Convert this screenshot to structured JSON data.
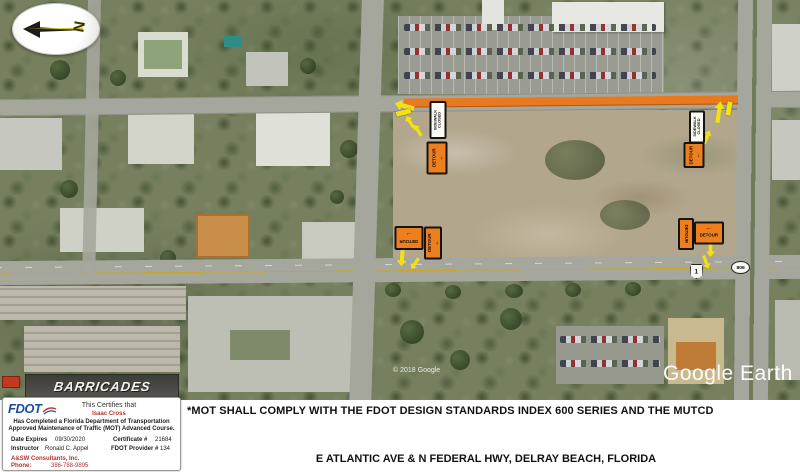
{
  "map": {
    "watermark": "Google Earth",
    "copyright": "© 2018 Google",
    "barricades_sign": "BARRICADES",
    "compass": {
      "letter": "N"
    },
    "shields": {
      "us1": "1",
      "sr806": "806"
    },
    "signs": {
      "sidewalk_closed": "SIDEWALK CLOSED",
      "detour": "DETOUR"
    }
  },
  "icons": {
    "arrow_left": "←",
    "arrow_right": "→"
  },
  "colors": {
    "work_zone_orange": "#E8791E",
    "sign_orange": "#EE7F1E",
    "marker_yellow": "#F2E20F"
  },
  "certification": {
    "logo_text": "FDOT",
    "certifies_label": "This Certifies that",
    "name": "Isaac Cross",
    "completion_line1": "Has Completed a Florida Department of Transportation",
    "completion_line2": "Approved Maintenance of Traffic (MOT) Advanced Course.",
    "date_expires_label": "Date Expires",
    "date_expires_value": "09/30/2020",
    "certificate_label": "Certificate #",
    "certificate_value": "21684",
    "instructor_label": "Instructor",
    "instructor_value": "Ronald C. Appel",
    "provider_label": "FDOT Provider #",
    "provider_value": "134",
    "company": "A&SW Consultants, Inc.",
    "phone_label": "Phone:",
    "phone_value": "386-788-9895"
  },
  "banner": {
    "mot_note": "*MOT SHALL COMPLY WITH THE FDOT DESIGN STANDARDS INDEX 600 SERIES AND THE MUTCD",
    "location_title": "E ATLANTIC AVE & N FEDERAL HWY, DELRAY BEACH, FLORIDA"
  }
}
